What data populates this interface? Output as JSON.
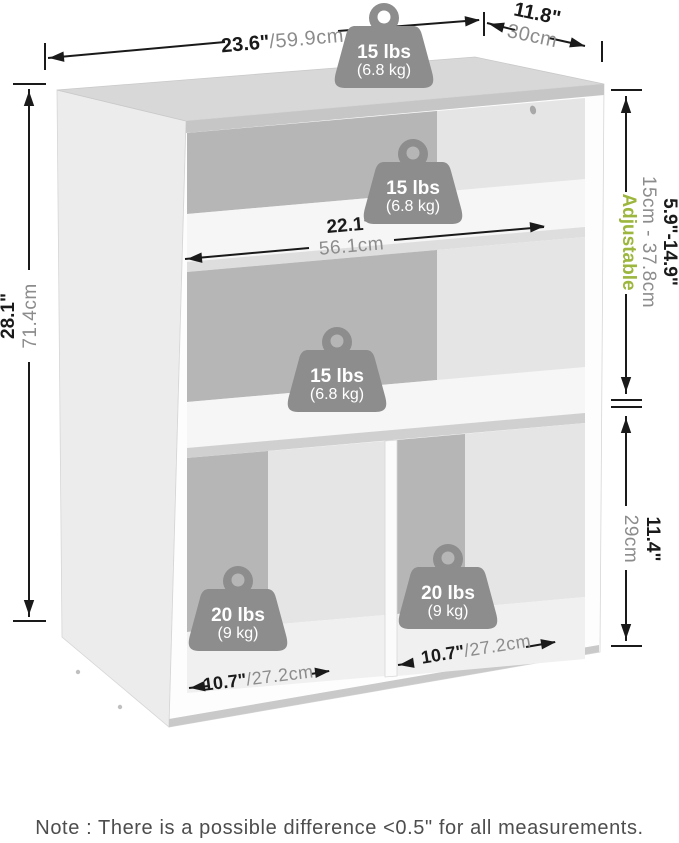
{
  "dims": {
    "width": {
      "in": "23.6\"",
      "cm": "/59.9cm"
    },
    "depth": {
      "in": "11.8\"",
      "cm": "30cm"
    },
    "height": {
      "in": "28.1\"",
      "cm": "71.4cm"
    },
    "shelf": {
      "in": "22.1\"",
      "cm": "56.1cm"
    },
    "adjustable": {
      "in": "5.9\"-14.9\"",
      "cm": "15cm - 37.8cm",
      "label": "Adjustable"
    },
    "lower": {
      "in": "11.4\"",
      "cm": "29cm"
    },
    "cubby_left": {
      "in": "10.7\"",
      "cm": "/27.2cm"
    },
    "cubby_right": {
      "in": "10.7\"",
      "cm": "/27.2cm"
    }
  },
  "weights": {
    "top": {
      "lbs": "15 lbs",
      "kg": "(6.8 kg)"
    },
    "upper_shelf": {
      "lbs": "15 lbs",
      "kg": "(6.8 kg)"
    },
    "middle_shelf": {
      "lbs": "15 lbs",
      "kg": "(6.8 kg)"
    },
    "left_cubby": {
      "lbs": "20 lbs",
      "kg": "(9 kg)"
    },
    "right_cubby": {
      "lbs": "20 lbs",
      "kg": "(9 kg)"
    }
  },
  "note": {
    "text": "Note : There is a possible difference <0.5\" for all measurements."
  },
  "colors": {
    "adjustable_green": "#9cb63e",
    "dimension_gray": "#8c8c8c",
    "line_black": "#1a1a1a",
    "badge_gray": "#8d8d8d"
  }
}
